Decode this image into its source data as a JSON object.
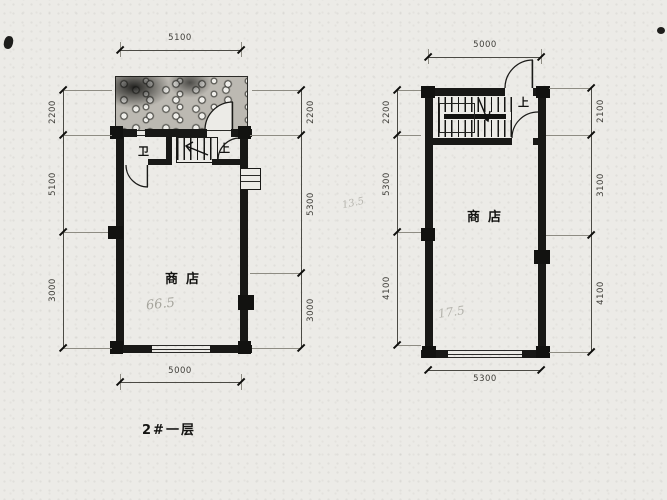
{
  "title": "2#一层",
  "colors": {
    "ink": "#181816",
    "paper": "#ecebe7",
    "pencil": "#a6a59d",
    "dim_text": "#3f3e39"
  },
  "left_plan": {
    "room_label": "商店",
    "area_note": "66.5",
    "wc_label": "卫",
    "up_label": "上",
    "dim_top": "5100",
    "dim_bottom": "5000",
    "dims_left": [
      "2200",
      "5100",
      "3000"
    ],
    "dims_right": [
      "2200",
      "5300",
      "3000"
    ]
  },
  "right_plan": {
    "room_label": "商店",
    "area_note": "17.5",
    "up_label": "上",
    "pencil_note": "13.5",
    "dim_top": "5000",
    "dim_bottom": "5300",
    "dims_left": [
      "2200",
      "5300",
      "4100"
    ],
    "dims_right": [
      "2100",
      "3100",
      "4100"
    ]
  }
}
